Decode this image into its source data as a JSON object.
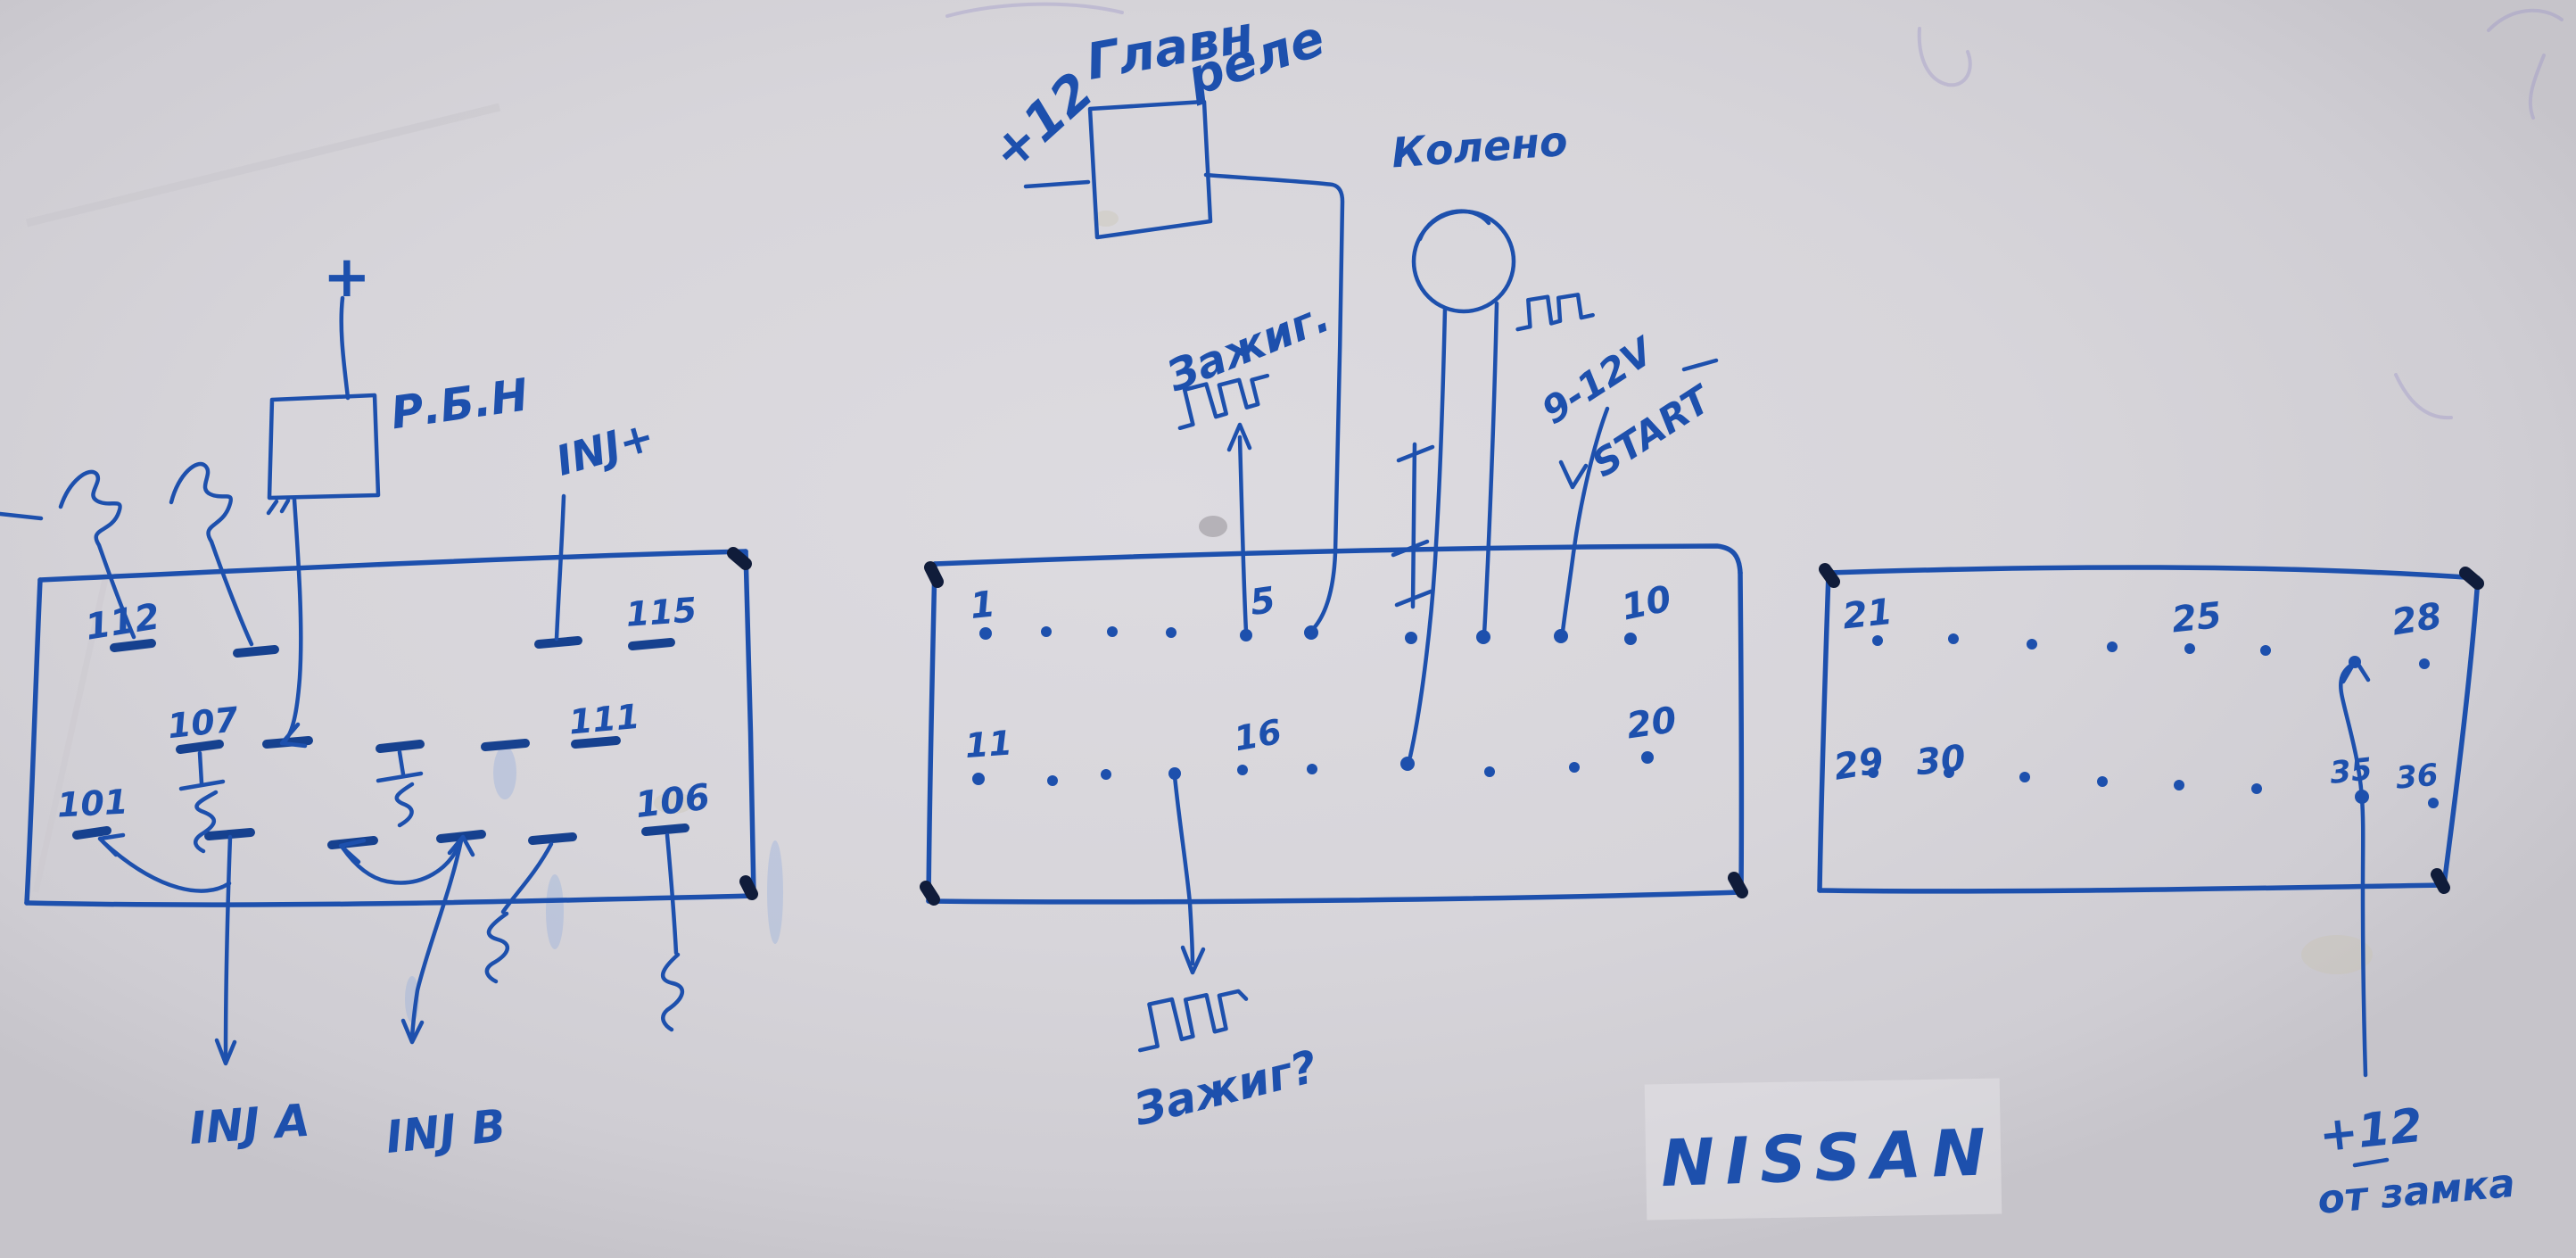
{
  "title": "Hand-drawn Nissan ECU wiring sketch",
  "colors": {
    "ink": "#1d50ad",
    "ink_dark": "#16418f",
    "corner_blob": "#101c3a",
    "paper": "#d7d5da",
    "ghost": "#9b94c8",
    "smudge": "#7da3dd"
  },
  "labels": {
    "plus12_relay": "+12",
    "main_relay_word1": "Главн",
    "main_relay_word2": "реле",
    "ignition_top": "Зажиг.",
    "crank_sensor": "Колено",
    "start_volts": "9-12V",
    "start_word": "START",
    "fuel_pump_relay": "Р.Б.Н",
    "plus_sign": "+",
    "inj_plus": "INJ+",
    "inj_a": "INJ A",
    "inj_b": "INJ B",
    "ignition_bottom": "Зажиг?",
    "brand": "NISSAN",
    "plus12_lock": "+12",
    "from_lock": "от замка"
  },
  "left_block": {
    "pins": {
      "p112": "112",
      "p115": "115",
      "p107": "107",
      "p111": "111",
      "p101": "101",
      "p106": "106"
    }
  },
  "middle_block": {
    "pins": {
      "p1": "1",
      "p5": "5",
      "p10": "10",
      "p11": "11",
      "p16": "16",
      "p20": "20"
    }
  },
  "right_block": {
    "pins": {
      "p21": "21",
      "p25": "25",
      "p28": "28",
      "p29": "29",
      "p30": "30",
      "p35": "35",
      "p36": "36"
    }
  }
}
